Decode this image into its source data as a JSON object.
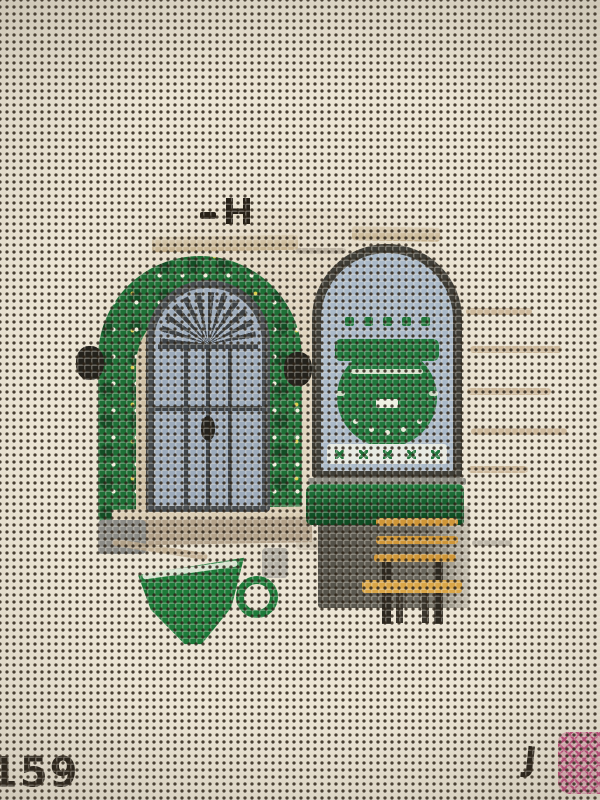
{
  "marks": {
    "canvas_number": "159",
    "artist_initial": "J"
  },
  "colors": {
    "canvas_ecru": "#eae3d2",
    "mesh_hole": "#352a1c",
    "paint_beige": "#cfc0a4",
    "wreath_green": "#1e6f36",
    "wreath_green_dark": "#134d25",
    "dot_white": "#f3efdf",
    "dot_yellow": "#ddce4e",
    "door_gray": "#9dabbb",
    "door_frame_dark": "#474c4f",
    "door_detail_dark": "#3e4347",
    "window_frame_dark": "#3f3e37",
    "window_glass_blue": "#aab9c8",
    "logo_green": "#20763c",
    "hedge_green": "#227a3e",
    "hedge_green_dark": "#0f4d24",
    "step_taupe": "#b3a28a",
    "step_light": "#d9ccb3",
    "lintel_tan": "#c4b08c",
    "bench_orange": "#cf9638",
    "bench_seat_orange": "#daa648",
    "bench_leg_dark": "#2c2820",
    "cup_green": "#1d7a39",
    "ink_black": "#262017",
    "stitch_pink": "#c24f80",
    "sketch_tan": "#b08f66",
    "railing_gray": "#8b8b86"
  }
}
